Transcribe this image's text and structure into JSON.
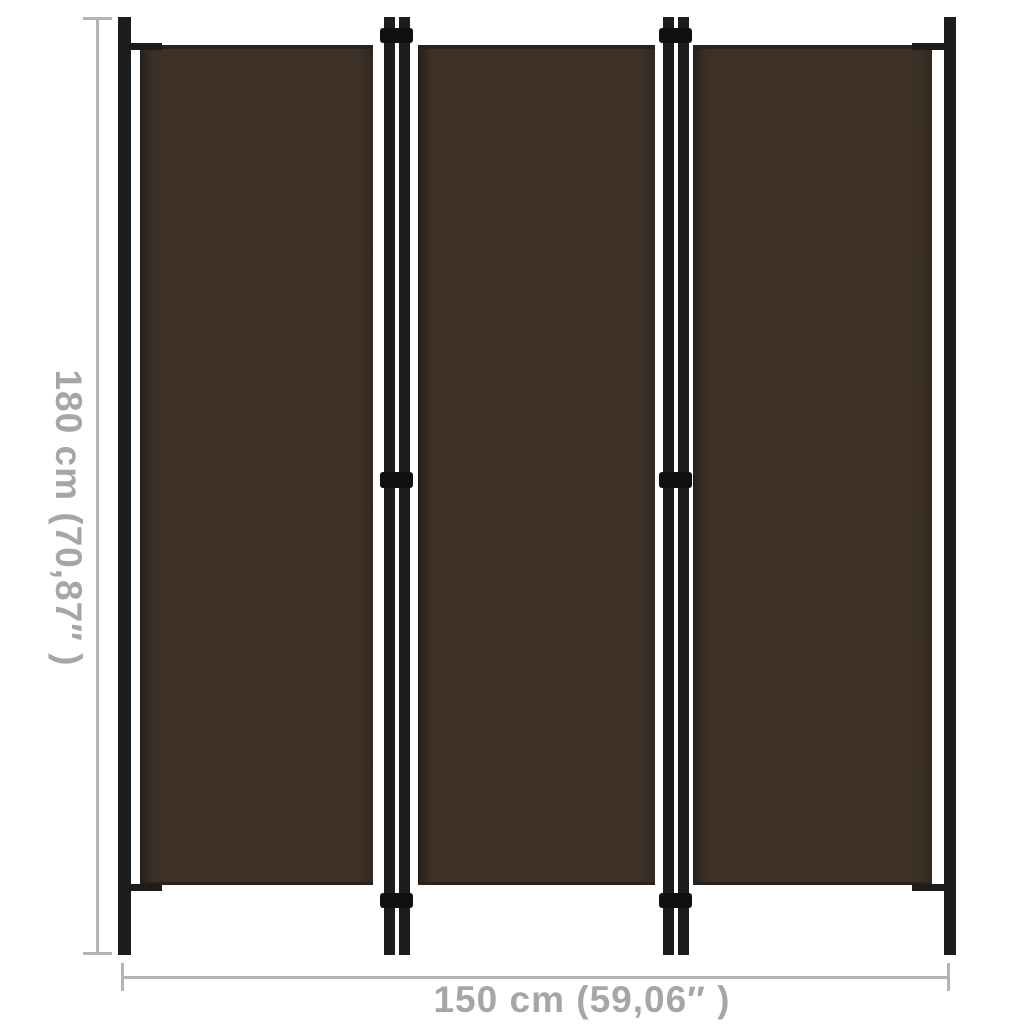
{
  "product": {
    "description": "3-panel brown room divider dimension diagram",
    "panel_count": 3
  },
  "dimensions": {
    "height": {
      "label": "180 cm (70,87″ )"
    },
    "width": {
      "label": "150 cm (59,06″ )"
    }
  },
  "panels": [
    {
      "name": "left-panel"
    },
    {
      "name": "middle-panel"
    },
    {
      "name": "right-panel"
    }
  ],
  "colors": {
    "background": "#ffffff",
    "panel_fabric": "#3d3127",
    "panel_edge_shade": "#2a211b",
    "frame_pole": "#1c1c1c",
    "hinge": "#101010",
    "dimension_line": "#b4b4b4",
    "dimension_text": "#a6a6a6"
  }
}
